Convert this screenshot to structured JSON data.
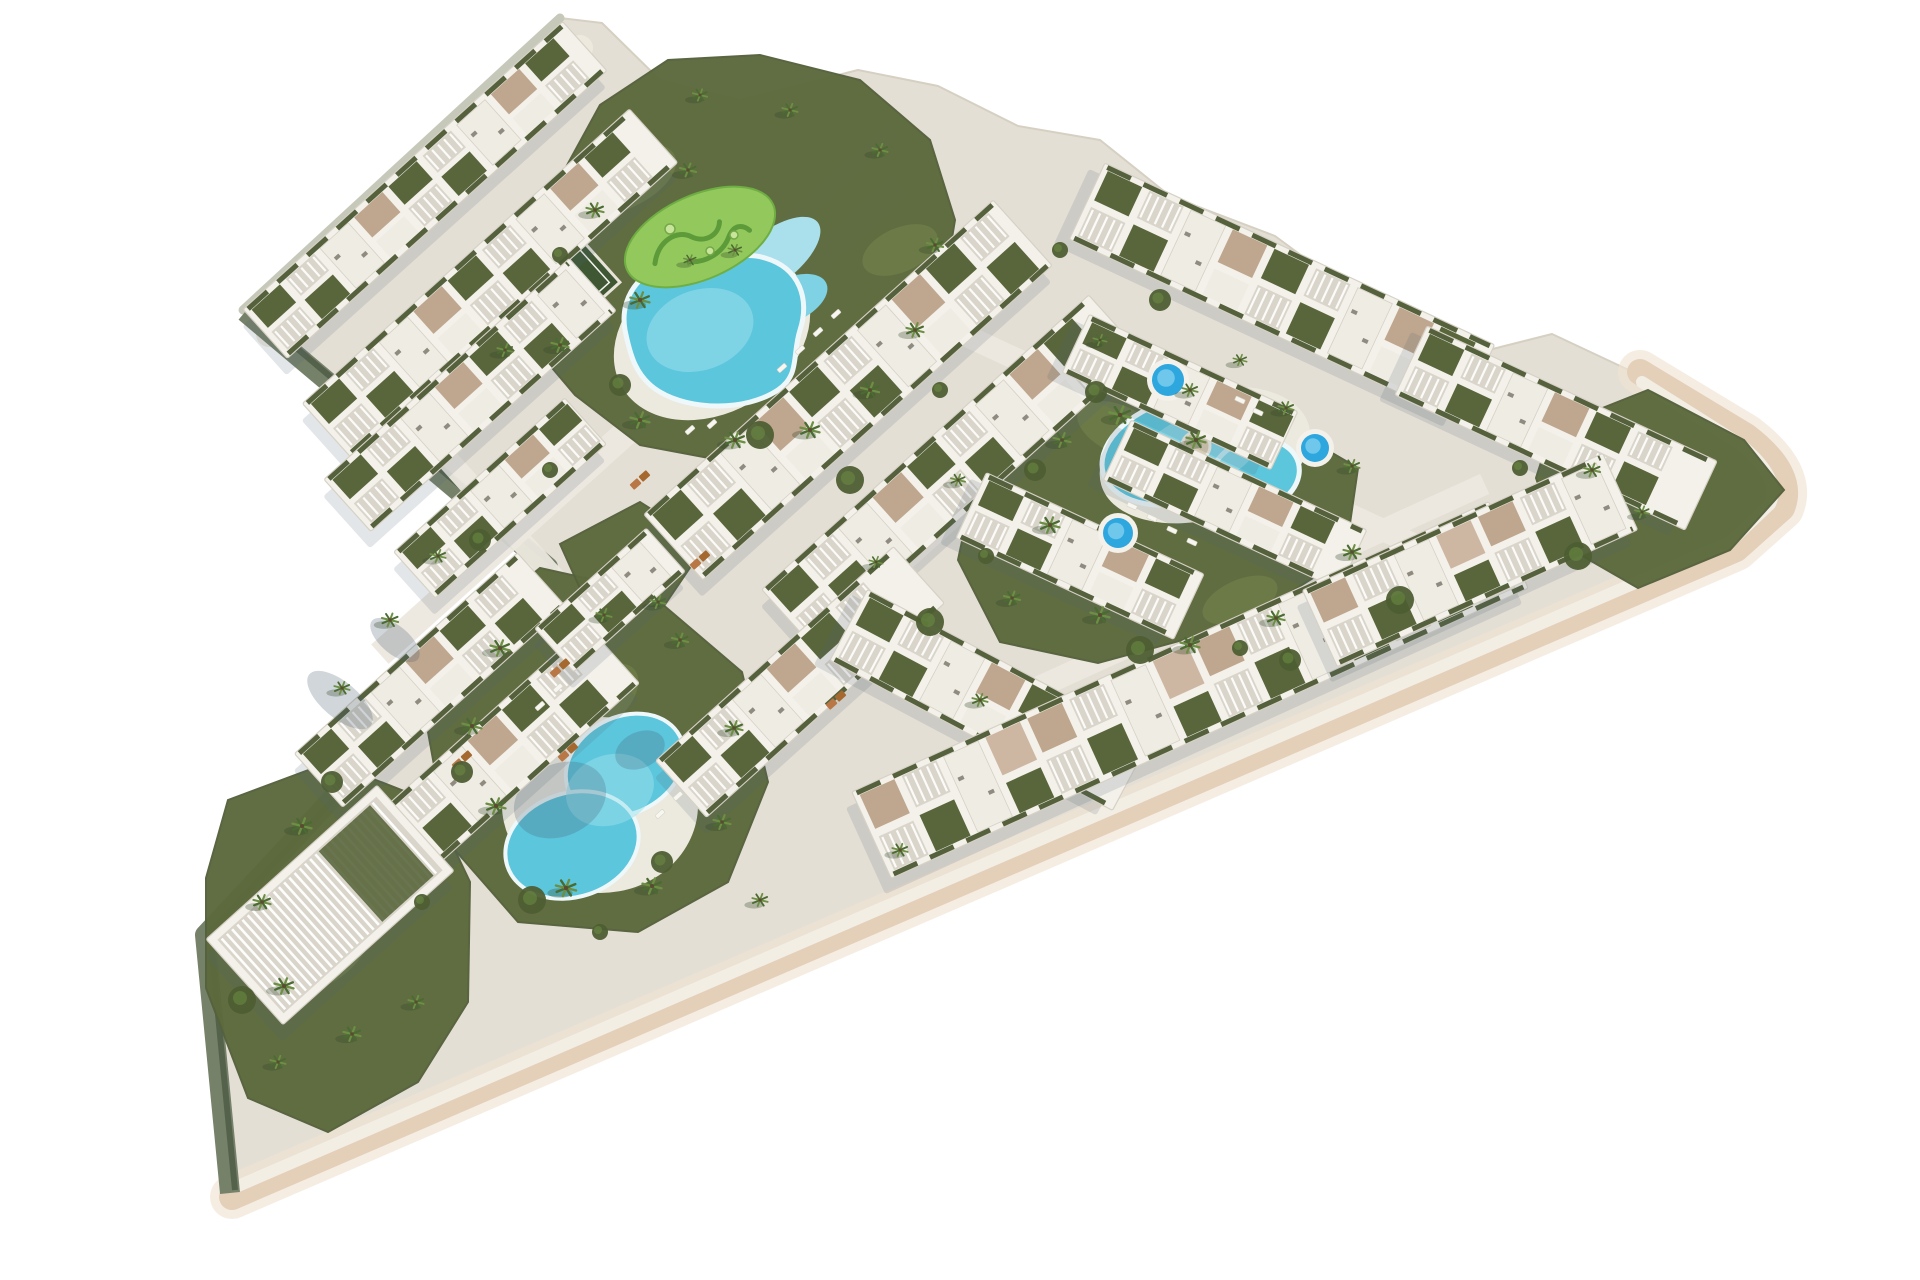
{
  "scene": {
    "description": "aerial-3d-render-residential-resort-masterplan",
    "background": "#ffffff",
    "colors": {
      "ground": "#e4dfd5",
      "groundEdge": "#d6d0c3",
      "promenade": "#edeade",
      "path": "#ece8df",
      "edgeBeige": "#e4cfb9",
      "edgeBeigeLight": "#f0e4d2",
      "edgeCream": "#f3eee4",
      "edgeGrey": "#c6c8ba",
      "wallSage": "#76816a",
      "wallDark": "#4e5a44",
      "turf": "#5c6a3d",
      "lawn": "#6e7d49",
      "minigolf": "#93c95c",
      "minigolfPath": "#5d9b3a",
      "court": "#3f5733",
      "building": "#f3f1ea",
      "buildingEdge": "#d6d1c6",
      "roofWhite": "#efece4",
      "roofGarden": "#59663c",
      "tanRoof": "#bfa68e",
      "tanRoofLight": "#cdb7a2",
      "pergolaBase": "#d9d5cb",
      "hedge": "#55613c",
      "acUnit": "#8f8b80",
      "shadow": "rgba(80,100,120,0.16)",
      "poolWater": "#5cc6dc",
      "poolLight": "#9adfec",
      "poolArm": "#aadfec",
      "poolDeck": "#eceade",
      "poolRim": "#eef8fa",
      "spaWater": "#2ea7df",
      "spaLight": "#7fd0ef",
      "islandSand": "#d8cbb0",
      "palmDark": "#4a6b31",
      "palmLight": "#6d8f44",
      "palmShadow": "rgba(50,70,40,0.30)",
      "trunk": "#5d4a33",
      "bush": "#4e5e33",
      "lounger": "#f7f6f1",
      "sunbedA": "#b97746",
      "sunbedB": "#a5682f",
      "treeShade": "rgba(70,90,110,0.25)"
    },
    "outline": [
      [
        243,
        310
      ],
      [
        560,
        18
      ],
      [
        602,
        23
      ],
      [
        660,
        80
      ],
      [
        740,
        100
      ],
      [
        858,
        70
      ],
      [
        938,
        86
      ],
      [
        1018,
        126
      ],
      [
        1100,
        140
      ],
      [
        1170,
        196
      ],
      [
        1275,
        236
      ],
      [
        1356,
        296
      ],
      [
        1465,
        356
      ],
      [
        1552,
        334
      ],
      [
        1650,
        380
      ],
      [
        1746,
        434
      ],
      [
        1790,
        488
      ],
      [
        1736,
        548
      ],
      [
        232,
        1197
      ],
      [
        205,
        935
      ],
      [
        548,
        567
      ]
    ],
    "edges": {
      "topleft": "M 243 310 L 560 18",
      "notch": "M 245 312 L 548 567 L 205 935 L 230 1193",
      "bottom_outer": "M 1640 372 L 1746 436 Q 1796 474 1782 508 L 1736 549 L 232 1197",
      "bottom_inner": "M 1642 382 L 1740 444 Q 1782 478 1770 504 L 1730 542 L 238 1186",
      "promenade": "M 269 334 L 580 48"
    },
    "greens": [
      {
        "name": "main-pool-garden",
        "points": [
          [
            548,
            200
          ],
          [
            600,
            105
          ],
          [
            668,
            60
          ],
          [
            760,
            55
          ],
          [
            860,
            80
          ],
          [
            930,
            140
          ],
          [
            955,
            220
          ],
          [
            940,
            310
          ],
          [
            895,
            400
          ],
          [
            820,
            450
          ],
          [
            730,
            462
          ],
          [
            640,
            445
          ],
          [
            575,
            395
          ],
          [
            520,
            330
          ],
          [
            505,
            255
          ]
        ]
      },
      {
        "name": "right-pool-garden",
        "points": [
          [
            1008,
            432
          ],
          [
            1120,
            378
          ],
          [
            1245,
            402
          ],
          [
            1358,
            468
          ],
          [
            1345,
            558
          ],
          [
            1238,
            625
          ],
          [
            1098,
            663
          ],
          [
            1000,
            642
          ],
          [
            958,
            560
          ],
          [
            975,
            480
          ]
        ]
      },
      {
        "name": "bottom-pool-garden",
        "points": [
          [
            452,
            640
          ],
          [
            540,
            568
          ],
          [
            648,
            592
          ],
          [
            742,
            672
          ],
          [
            768,
            782
          ],
          [
            728,
            882
          ],
          [
            638,
            932
          ],
          [
            518,
            922
          ],
          [
            448,
            842
          ],
          [
            428,
            732
          ]
        ]
      },
      {
        "name": "tip-garden",
        "points": [
          [
            228,
            800
          ],
          [
            330,
            762
          ],
          [
            432,
            802
          ],
          [
            470,
            882
          ],
          [
            468,
            1002
          ],
          [
            418,
            1082
          ],
          [
            328,
            1132
          ],
          [
            248,
            1098
          ],
          [
            206,
            988
          ],
          [
            206,
            878
          ]
        ]
      },
      {
        "name": "right-tip-garden",
        "points": [
          [
            1552,
            428
          ],
          [
            1648,
            390
          ],
          [
            1744,
            440
          ],
          [
            1784,
            490
          ],
          [
            1730,
            550
          ],
          [
            1638,
            588
          ],
          [
            1558,
            542
          ],
          [
            1536,
            478
          ]
        ]
      },
      {
        "name": "notch-garden",
        "points": [
          [
            560,
            544
          ],
          [
            640,
            502
          ],
          [
            706,
            544
          ],
          [
            664,
            606
          ],
          [
            588,
            606
          ]
        ]
      }
    ],
    "lawns": [
      [
        620,
        180,
        60,
        30,
        -24
      ],
      [
        900,
        250,
        40,
        22,
        -24
      ],
      [
        1120,
        430,
        46,
        24,
        25
      ],
      [
        1240,
        600,
        40,
        20,
        -24
      ],
      [
        600,
        700,
        46,
        26,
        -42
      ],
      [
        330,
        950,
        50,
        28,
        -42
      ]
    ],
    "roads": [
      {
        "cx": 640,
        "cy": 420,
        "len": 700,
        "w": 26,
        "rot": -42
      },
      {
        "cx": 870,
        "cy": 590,
        "len": 560,
        "w": 24,
        "rot": -42
      },
      {
        "cx": 1190,
        "cy": 440,
        "len": 560,
        "w": 22,
        "rot": 25
      },
      {
        "cx": 1230,
        "cy": 600,
        "len": 560,
        "w": 22,
        "rot": -24.5
      },
      {
        "cx": 520,
        "cy": 540,
        "len": 300,
        "w": 22,
        "rot": 48
      },
      {
        "cx": 760,
        "cy": 250,
        "len": 360,
        "w": 18,
        "rot": -42
      }
    ],
    "rows": [
      {
        "name": "row-topleft-1",
        "cx": 425,
        "cy": 190,
        "len": 430,
        "w": 66,
        "rot": -42,
        "style": "mixed"
      },
      {
        "name": "row-topleft-2",
        "cx": 490,
        "cy": 283,
        "len": 440,
        "w": 72,
        "rot": -42,
        "style": "mixed"
      },
      {
        "name": "row-topleft-3",
        "cx": 470,
        "cy": 395,
        "len": 330,
        "w": 70,
        "rot": -42,
        "style": "mixed"
      },
      {
        "name": "row-topleft-4",
        "cx": 500,
        "cy": 498,
        "len": 230,
        "w": 62,
        "rot": -42,
        "style": "mixed"
      },
      {
        "name": "row-central-1",
        "cx": 848,
        "cy": 390,
        "len": 470,
        "w": 88,
        "rot": -42,
        "style": "mixed"
      },
      {
        "name": "row-central-2",
        "cx": 952,
        "cy": 472,
        "len": 440,
        "w": 80,
        "rot": -42,
        "style": "mixed"
      },
      {
        "name": "row-bottomcenter-1",
        "cx": 800,
        "cy": 682,
        "len": 320,
        "w": 76,
        "rot": -42,
        "style": "mixed"
      },
      {
        "name": "row-bottomcenter-2",
        "cx": 990,
        "cy": 700,
        "len": 320,
        "w": 80,
        "rot": 28,
        "style": "mixed"
      },
      {
        "name": "row-rightwing-top-1",
        "cx": 1282,
        "cy": 292,
        "len": 430,
        "w": 84,
        "rot": 25,
        "style": "mixed"
      },
      {
        "name": "row-rightwing-top-2",
        "cx": 1180,
        "cy": 392,
        "len": 230,
        "w": 64,
        "rot": 25,
        "style": "mixed"
      },
      {
        "name": "row-righttip",
        "cx": 1556,
        "cy": 428,
        "len": 320,
        "w": 76,
        "rot": 25,
        "style": "mixed"
      },
      {
        "name": "row-rightwing-mid-1",
        "cx": 1080,
        "cy": 556,
        "len": 240,
        "w": 72,
        "rot": 25,
        "style": "mixed"
      },
      {
        "name": "row-rightwing-mid-2",
        "cx": 1235,
        "cy": 505,
        "len": 260,
        "w": 66,
        "rot": 25,
        "style": "mixed"
      },
      {
        "name": "row-bottomband-1",
        "cx": 1190,
        "cy": 690,
        "len": 700,
        "w": 95,
        "rot": -24.5,
        "style": "tan"
      },
      {
        "name": "row-bottomband-2",
        "cx": 1470,
        "cy": 560,
        "len": 330,
        "w": 84,
        "rot": -24.5,
        "style": "tan"
      },
      {
        "name": "row-wedge-1",
        "cx": 430,
        "cy": 680,
        "len": 300,
        "w": 72,
        "rot": -42,
        "style": "mixed"
      },
      {
        "name": "row-wedge-2",
        "cx": 498,
        "cy": 758,
        "len": 310,
        "w": 78,
        "rot": -42,
        "style": "mixed"
      },
      {
        "name": "row-wedge-3",
        "cx": 610,
        "cy": 600,
        "len": 150,
        "w": 58,
        "rot": -42,
        "style": "mixed"
      },
      {
        "name": "clubhouse",
        "cx": 330,
        "cy": 905,
        "len": 230,
        "w": 115,
        "rot": -42,
        "style": "pergola"
      }
    ],
    "pools": {
      "main": {
        "deck": [
          712,
          335,
          104,
          78,
          -30
        ],
        "body": "M 625 330 C 618 290 650 260 690 262 C 720 264 740 250 765 258 C 800 268 810 300 800 330 C 792 355 800 375 778 390 C 745 412 690 410 660 392 C 636 378 630 355 625 330 Z",
        "arm1": [
          772,
          258,
          58,
          26,
          -38
        ],
        "arm2": [
          790,
          300,
          40,
          22,
          -25
        ],
        "inner": [
          700,
          330,
          55,
          40,
          -20
        ],
        "island": [
          700,
          237,
          80,
          42,
          -24
        ],
        "island_rot": "rotate(-24 700 237)",
        "squiggle1": "M 648 243 C 660 223 682 221 692 233 C 702 245 718 243 724 231",
        "squiggle2": "M 680 255 C 694 263 714 261 726 249 C 736 239 744 243 748 251,",
        "dots": [
          [
            670,
            229,
            5
          ],
          [
            710,
            251,
            4
          ],
          [
            734,
            235,
            4
          ]
        ]
      },
      "right": {
        "deck": [
          1205,
          455,
          108,
          64,
          -16
        ],
        "body1": [
          1185,
          450,
          85,
          52,
          -16
        ],
        "body2": [
          1255,
          475,
          45,
          35,
          -16
        ],
        "inner": [
          1200,
          450,
          60,
          35,
          -16
        ],
        "island": [
          1196,
          446,
          14
        ]
      },
      "bottom": {
        "deck": [
          600,
          805,
          98,
          88,
          0
        ],
        "body1": [
          625,
          765,
          62,
          48,
          -28
        ],
        "body2": [
          572,
          845,
          68,
          52,
          -18
        ],
        "inner": [
          610,
          790,
          45,
          35,
          -20
        ],
        "shade1": [
          560,
          800,
          48,
          36,
          -25
        ],
        "shade2": [
          640,
          750,
          26,
          18,
          -25
        ]
      }
    },
    "spas": [
      [
        1168,
        380,
        16
      ],
      [
        1315,
        448,
        14
      ],
      [
        1118,
        533,
        15
      ]
    ],
    "court": {
      "cx": 565,
      "cy": 290,
      "w": 92,
      "h": 62,
      "rot": -42
    },
    "minigolf_center": [
      700,
      237
    ],
    "palms": [
      [
        595,
        210,
        0.9
      ],
      [
        640,
        300,
        1.0
      ],
      [
        688,
        170,
        0.85
      ],
      [
        560,
        345,
        0.9
      ],
      [
        640,
        420,
        1.0
      ],
      [
        735,
        440,
        1.0
      ],
      [
        810,
        430,
        1.0
      ],
      [
        870,
        390,
        0.95
      ],
      [
        915,
        330,
        0.9
      ],
      [
        935,
        245,
        0.85
      ],
      [
        880,
        150,
        0.8
      ],
      [
        790,
        110,
        0.8
      ],
      [
        700,
        95,
        0.75
      ],
      [
        735,
        250,
        0.7
      ],
      [
        690,
        260,
        0.65
      ],
      [
        505,
        350,
        0.8
      ],
      [
        1062,
        440,
        0.9
      ],
      [
        1050,
        525,
        1.0
      ],
      [
        1100,
        615,
        1.0
      ],
      [
        1190,
        645,
        1.0
      ],
      [
        1276,
        618,
        0.9
      ],
      [
        1352,
        552,
        0.9
      ],
      [
        1352,
        466,
        0.8
      ],
      [
        1286,
        408,
        0.8
      ],
      [
        1190,
        390,
        0.8
      ],
      [
        1120,
        415,
        1.1
      ],
      [
        1196,
        440,
        1.0
      ],
      [
        500,
        648,
        1.0
      ],
      [
        472,
        726,
        1.0
      ],
      [
        496,
        806,
        1.0
      ],
      [
        566,
        888,
        1.05
      ],
      [
        652,
        886,
        1.0
      ],
      [
        722,
        822,
        0.9
      ],
      [
        734,
        728,
        0.9
      ],
      [
        680,
        640,
        0.85
      ],
      [
        604,
        615,
        0.8
      ],
      [
        302,
        826,
        1.0
      ],
      [
        262,
        902,
        0.9
      ],
      [
        284,
        986,
        1.0
      ],
      [
        352,
        1034,
        0.9
      ],
      [
        416,
        1002,
        0.8
      ],
      [
        278,
        1062,
        0.8
      ],
      [
        438,
        556,
        0.8
      ],
      [
        390,
        620,
        0.85
      ],
      [
        342,
        688,
        0.8
      ],
      [
        1592,
        470,
        0.85
      ],
      [
        1642,
        512,
        0.75
      ],
      [
        658,
        602,
        0.8
      ],
      [
        958,
        480,
        0.75
      ],
      [
        1012,
        598,
        0.85
      ],
      [
        876,
        562,
        0.7
      ],
      [
        1100,
        340,
        0.7
      ],
      [
        1240,
        360,
        0.7
      ],
      [
        980,
        700,
        0.8
      ],
      [
        900,
        850,
        0.8
      ],
      [
        760,
        900,
        0.8
      ]
    ],
    "bushes": [
      [
        560,
        255
      ],
      [
        620,
        385
      ],
      [
        760,
        435
      ],
      [
        940,
        390
      ],
      [
        1035,
        470
      ],
      [
        1140,
        650
      ],
      [
        1240,
        648
      ],
      [
        462,
        772
      ],
      [
        532,
        900
      ],
      [
        600,
        932
      ],
      [
        332,
        782
      ],
      [
        242,
        1000
      ],
      [
        422,
        902
      ],
      [
        662,
        862
      ],
      [
        1578,
        556
      ],
      [
        1520,
        468
      ],
      [
        1096,
        392
      ],
      [
        930,
        622
      ],
      [
        986,
        556
      ],
      [
        1290,
        660
      ],
      [
        1400,
        600
      ],
      [
        550,
        470
      ],
      [
        480,
        540
      ],
      [
        850,
        480
      ],
      [
        1060,
        250
      ],
      [
        1160,
        300
      ]
    ],
    "loungers": [
      {
        "x": 800,
        "y": 350,
        "rot": -42
      },
      {
        "x": 818,
        "y": 332,
        "rot": -42
      },
      {
        "x": 836,
        "y": 314,
        "rot": -42
      },
      {
        "x": 782,
        "y": 368,
        "rot": -42
      },
      {
        "x": 690,
        "y": 430,
        "rot": -42
      },
      {
        "x": 712,
        "y": 424,
        "rot": -42
      },
      {
        "x": 1152,
        "y": 518,
        "rot": 25
      },
      {
        "x": 1172,
        "y": 530,
        "rot": 25
      },
      {
        "x": 1192,
        "y": 542,
        "rot": 25
      },
      {
        "x": 1132,
        "y": 506,
        "rot": 25
      },
      {
        "x": 1240,
        "y": 400,
        "rot": 25
      },
      {
        "x": 1258,
        "y": 412,
        "rot": 25
      },
      {
        "x": 540,
        "y": 706,
        "rot": -42
      },
      {
        "x": 558,
        "y": 688,
        "rot": -42
      },
      {
        "x": 660,
        "y": 814,
        "rot": -42
      },
      {
        "x": 678,
        "y": 796,
        "rot": -42
      }
    ],
    "sunbeds": [
      [
        560,
        668
      ],
      [
        462,
        760
      ],
      [
        568,
        752
      ],
      [
        836,
        700
      ],
      [
        700,
        560
      ],
      [
        640,
        480
      ]
    ],
    "tree_shades": [
      [
        340,
        700,
        40,
        18,
        40
      ],
      [
        395,
        640,
        30,
        14,
        40
      ]
    ]
  }
}
